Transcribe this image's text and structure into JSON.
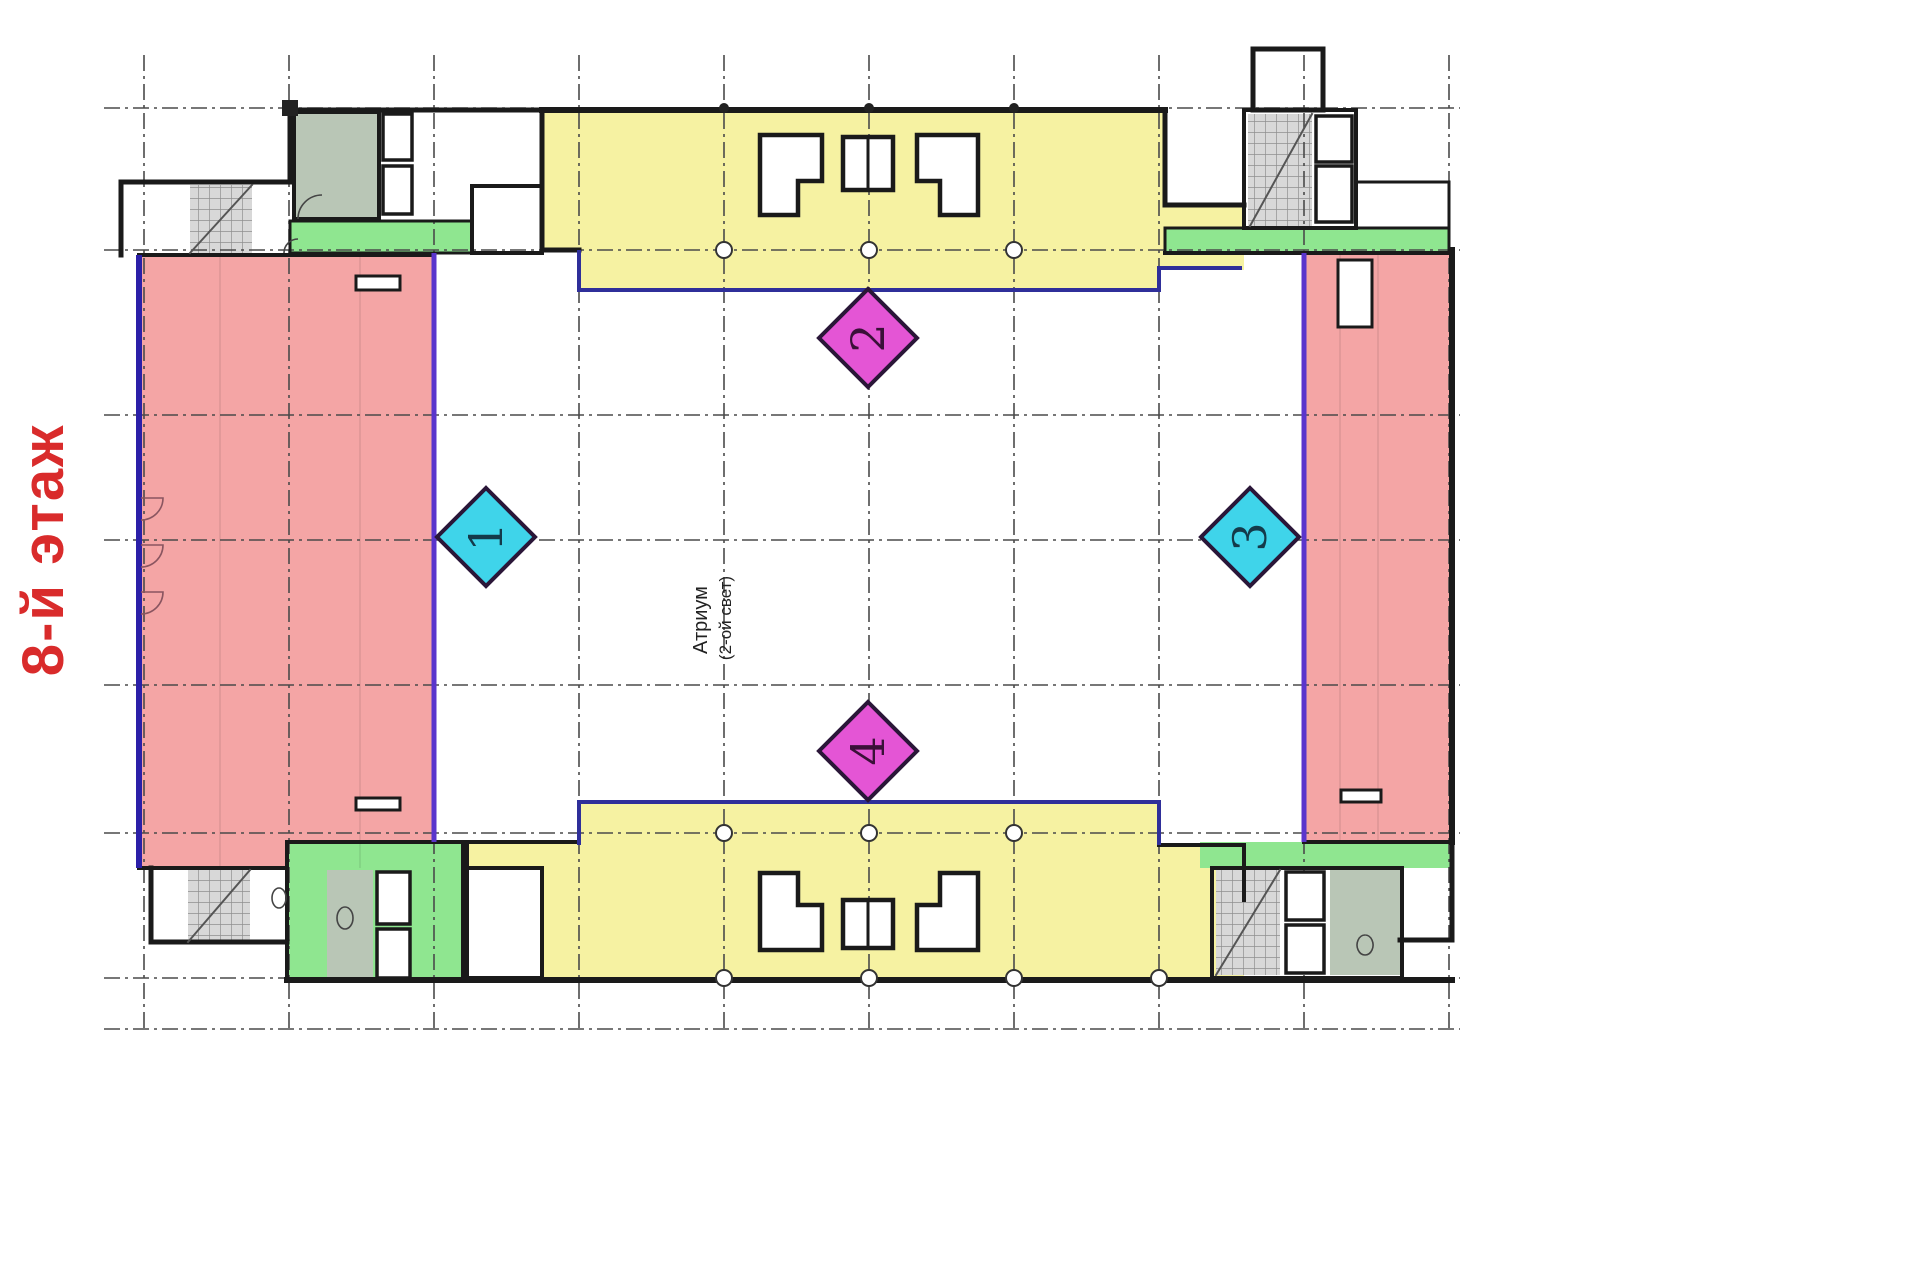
{
  "floor_label": "8-й этаж",
  "atrium": {
    "line1": "Атриум",
    "line2": "(2-ой свет)"
  },
  "markers": [
    {
      "label": "1",
      "color": "cyan",
      "position": "left-mid"
    },
    {
      "label": "2",
      "color": "magenta",
      "position": "top-center"
    },
    {
      "label": "3",
      "color": "cyan",
      "position": "right-mid"
    },
    {
      "label": "4",
      "color": "magenta",
      "position": "bottom-center"
    }
  ],
  "colors": {
    "background": "#ffffff",
    "pink": "#f4a5a5",
    "yellow": "#f6f2a2",
    "green": "#8fe690",
    "graygreen": "#b9c6b6",
    "cyan": "#3fd4ea",
    "magenta": "#e455d5",
    "navy": "#2f2f9a",
    "indigo": "#2b1fa8",
    "purple": "#5a35cc",
    "wall": "#1a1a1a",
    "grid": "#4a4a4a",
    "stair": "#d8d8d8",
    "label_red": "#d92b2b"
  }
}
